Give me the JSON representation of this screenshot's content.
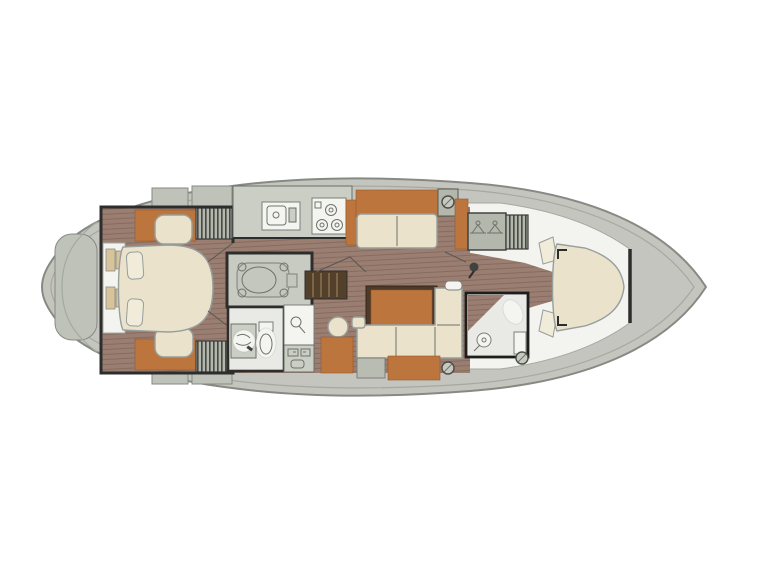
{
  "document": {
    "type": "sailboat interior floor plan",
    "orientation": "bow to the right, stern to the left",
    "text_content": "none (drawing contains no rendered text)"
  },
  "colors": {
    "page_bg": "#ffffff",
    "hull_fill": "#c4c5be",
    "hull_stroke": "#878a83",
    "deck_line": "#a6a9a0",
    "deck_piece": "#bfc2b9",
    "wall": "#2d2d2d",
    "wood": "#9a7e71",
    "wood_stripe": "#85695c",
    "orange": "#bd753e",
    "orange_stroke": "#96582c",
    "cream": "#eae2cb",
    "cream_light": "#f1ebda",
    "cream_stroke": "#979e9c",
    "counter": "#cacec4",
    "appliance": "#f4f5f1",
    "room_gray": "#c8cbc2",
    "head_floor": "#e9eae5",
    "white_floor": "#f3f4f0",
    "locker": "#b3b7ac",
    "steps": "#52402b",
    "steps_tread": "#7d6548",
    "tan": "#d8c49c",
    "stool_gray": "#b9bcb2",
    "table_border": "#4d3a28"
  },
  "rooms": [
    {
      "name": "aft owner cabin",
      "description": "island double berth with pillows, bedside shelves, two seats with orange vanities, two hanging wardrobes, two entry doors"
    },
    {
      "name": "galley",
      "description": "counter with sink and three-burner stove, tall orange cabinet"
    },
    {
      "name": "port dinette",
      "description": "straight settee with two cream cushions and orange backrest"
    },
    {
      "name": "engine room",
      "description": "centerline engine compartment with engine mounts"
    },
    {
      "name": "companionway steps",
      "description": "wooden stair treads beside engine room"
    },
    {
      "name": "aft head",
      "description": "washbasin, toilet, separate shower stall, storage cabinet"
    },
    {
      "name": "salon",
      "description": "orange dining table, L-shaped cream settee, orange bench, gray stool, round stool"
    },
    {
      "name": "forward head",
      "description": "toilet, shower rose, wet floor"
    },
    {
      "name": "hanging lockers",
      "description": "locker with two clothes hangers and slatted wardrobe"
    },
    {
      "name": "forward cabin",
      "description": "tapered V-berth with side benches on white floor"
    },
    {
      "name": "bow locker",
      "description": "sealed bow compartment forward of bulkhead"
    },
    {
      "name": "stern platform",
      "description": "rounded transom swim platform"
    }
  ],
  "fixtures": [
    {
      "name": "sink",
      "location": "galley"
    },
    {
      "name": "stove",
      "location": "galley",
      "burners": 3
    },
    {
      "name": "toilet",
      "location": "aft head"
    },
    {
      "name": "toilet",
      "location": "forward head"
    },
    {
      "name": "shower",
      "location": "aft head"
    },
    {
      "name": "shower",
      "location": "forward head"
    },
    {
      "name": "winch/deck fitting",
      "count": 2
    },
    {
      "name": "mast foot",
      "location": "forward of salon"
    }
  ]
}
